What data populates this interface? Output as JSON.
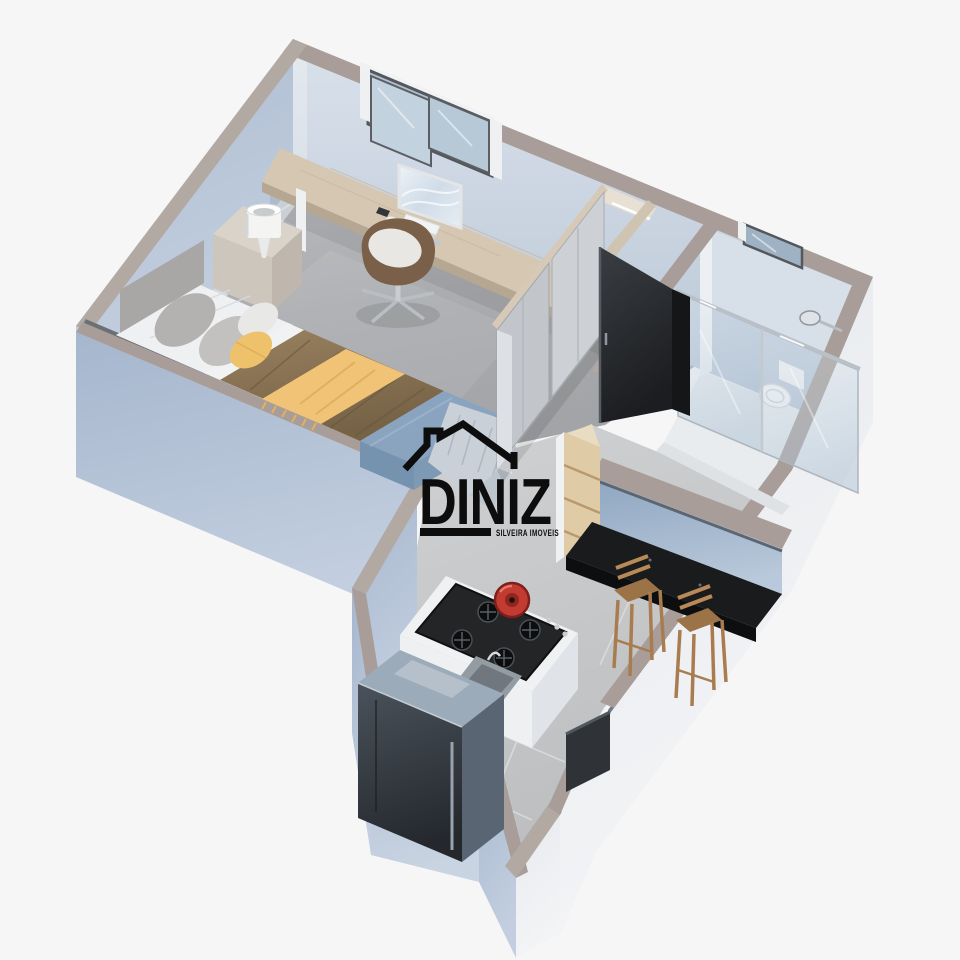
{
  "title": "3D isometric floor plan render of a studio apartment",
  "watermark": {
    "brand": "DINIZ",
    "tagline": "SILVEIRA IMOVEIS",
    "color": "#0d0d0d"
  },
  "palette": {
    "background": "#f6f6f7",
    "wall_top": "#a89d98",
    "wall_top_light": "#b3a9a3",
    "wall_exterior_blue": "#b2c0d4",
    "wall_exterior_light": "#eaedf0",
    "wall_interior": "#cfd9e4",
    "floor_bedroom": "#aeb0b3",
    "floor_kitchen": "#c7c9cb",
    "floor_bathroom": "#e9ebed",
    "bed_sheet_white": "#eef0f2",
    "bed_duvet_brown": "#8a7454",
    "bed_throw_yellow": "#f0c377",
    "bench_blue": "#8aa4c0",
    "blanket_gray": "#c9d0d7",
    "wood_light": "#d5c7b2",
    "wood_shelf": "#dfcba6",
    "counter_black": "#1a1b1d",
    "door_dark": "#2b2d31",
    "pot_red": "#c23b31",
    "chrome": "#c9ced3",
    "fridge_steel": "#9cabb9",
    "stool_wood": "#b78a58"
  },
  "scene": {
    "objects": [
      "bedroom-window",
      "bathroom-window",
      "desk",
      "desktop-monitor",
      "keyboard",
      "mouse",
      "smartphone",
      "office-chair",
      "nightstand",
      "table-lamp",
      "double-bed",
      "headboard",
      "pillows",
      "yellow-throw-blanket",
      "bed-bench",
      "gray-knit-blanket",
      "sliding-door-wardrobe",
      "bathroom-door",
      "shower-enclosure",
      "shower-head",
      "toilet",
      "bar-counter",
      "bar-stools",
      "open-shelf-unit",
      "kitchen-island",
      "gas-cooktop",
      "red-pot",
      "kitchen-sink",
      "refrigerator",
      "entry-door-panel"
    ]
  }
}
